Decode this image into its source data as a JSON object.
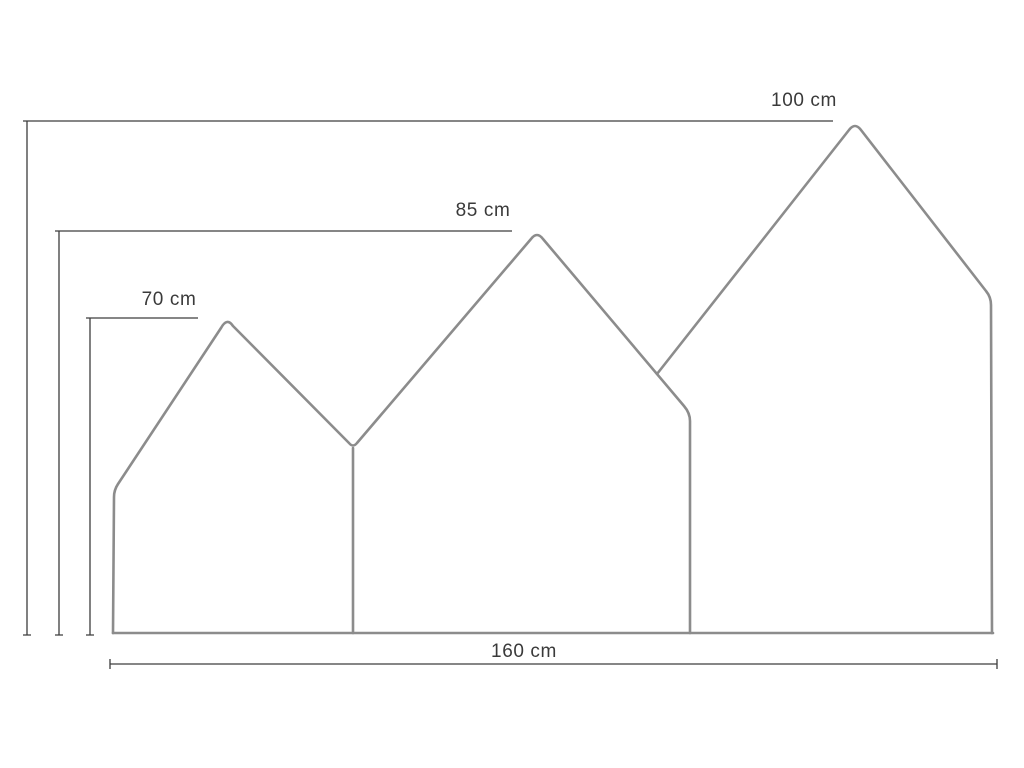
{
  "diagram": {
    "kind": "dimension-drawing",
    "subject": "three-house-silhouette-panel",
    "labels": {
      "height_large": "100 cm",
      "height_medium": "85 cm",
      "height_small": "70 cm",
      "width_total": "160 cm"
    },
    "dimensions": {
      "height_large_cm": 100,
      "height_medium_cm": 85,
      "height_small_cm": 70,
      "width_total_cm": 160
    },
    "colors": {
      "background": "#ffffff",
      "outline": "#8c8c8c",
      "dimension_line": "#3d3d3d",
      "label_text": "#3a3a3a"
    }
  }
}
